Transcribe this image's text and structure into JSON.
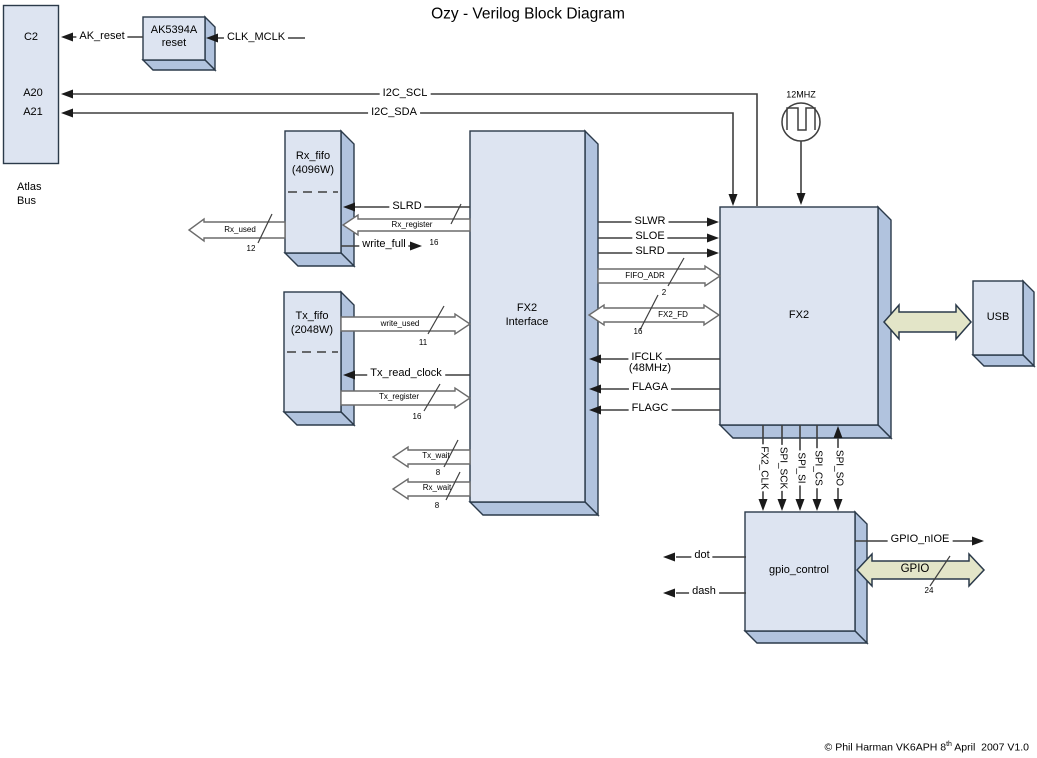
{
  "title": "Ozy - Verilog Block Diagram",
  "copyright": {
    "prefix": "© Phil Harman VK6APH 8",
    "superscript": "th",
    "suffix": " April  2007 V1.0"
  },
  "colors": {
    "block_face": "#dde4f1",
    "block_side": "#b1c3de",
    "block_outline": "#2b3a4a",
    "wire": "#3f3f3f",
    "bus_fill": "#ffffff",
    "bus_outline": "#6b6b6b",
    "wide_bus_fill": "#e3e5c8",
    "background": "#ffffff"
  },
  "blocks": {
    "atlas_bus": {
      "pins": {
        "c2": "C2",
        "a20": "A20",
        "a21": "A21"
      },
      "caption": {
        "line1": "Atlas",
        "line2": "Bus"
      }
    },
    "ak5394a_reset": {
      "line1": "AK5394A",
      "line2": "reset"
    },
    "rx_fifo": {
      "line1": "Rx_fifo",
      "line2": "(4096W)"
    },
    "tx_fifo": {
      "line1": "Tx_fifo",
      "line2": "(2048W)"
    },
    "fx2_interface": {
      "line1": "FX2",
      "line2": "Interface"
    },
    "fx2": {
      "label": "FX2"
    },
    "usb": {
      "label": "USB"
    },
    "gpio_control": {
      "label": "gpio_control"
    },
    "oscillator": {
      "label": "12MHZ"
    }
  },
  "signals": {
    "ak_reset": {
      "label": "AK_reset"
    },
    "clk_mclk": {
      "label": "CLK_MCLK"
    },
    "i2c_scl": {
      "label": "I2C_SCL"
    },
    "i2c_sda": {
      "label": "I2C_SDA"
    },
    "slrd_fifo": {
      "label": "SLRD"
    },
    "rx_register": {
      "label": "Rx_register",
      "width": "16"
    },
    "write_full": {
      "label": "write_full"
    },
    "rx_used": {
      "label": "Rx_used",
      "width": "12"
    },
    "write_used": {
      "label": "write_used",
      "width": "11"
    },
    "tx_read_clock": {
      "label": "Tx_read_clock"
    },
    "tx_register": {
      "label": "Tx_register",
      "width": "16"
    },
    "slwr": {
      "label": "SLWR"
    },
    "sloe": {
      "label": "SLOE"
    },
    "slrd": {
      "label": "SLRD"
    },
    "fifo_adr": {
      "label": "FIFO_ADR",
      "width": "2"
    },
    "fx2_fd": {
      "label": "FX2_FD",
      "width": "16"
    },
    "ifclk": {
      "label": "IFCLK",
      "sub": "(48MHz)"
    },
    "flaga": {
      "label": "FLAGA"
    },
    "flagc": {
      "label": "FLAGC"
    },
    "tx_wait": {
      "label": "Tx_wait",
      "width": "8"
    },
    "rx_wait": {
      "label": "Rx_wait",
      "width": "8"
    },
    "fx2_clk": {
      "label": "FX2_CLK"
    },
    "spi_sck": {
      "label": "SPI_SCK"
    },
    "spi_si": {
      "label": "SPI_SI"
    },
    "spi_cs": {
      "label": "SPI_CS"
    },
    "spi_so": {
      "label": "SPI_SO"
    },
    "dot": {
      "label": "dot"
    },
    "dash": {
      "label": "dash"
    },
    "gpio_nioe": {
      "label": "GPIO_nIOE"
    },
    "gpio": {
      "label": "GPIO",
      "width": "24"
    }
  }
}
